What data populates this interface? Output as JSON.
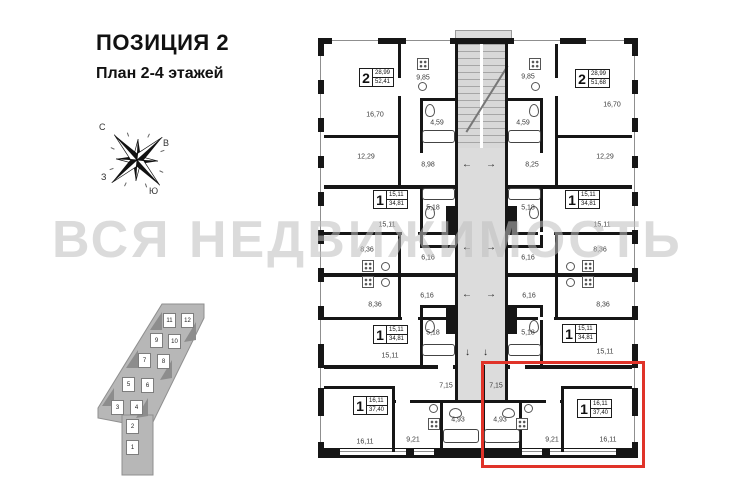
{
  "header": {
    "title": "ПОЗИЦИЯ 2",
    "subtitle": "План 2-4 этажей"
  },
  "watermark": "ВСЯ НЕДВИЖИМОСТЬ",
  "compass": {
    "n": "С",
    "e": "В",
    "s": "Ю",
    "w": "З"
  },
  "site_plan": {
    "blocks": [
      "1",
      "2",
      "3",
      "4",
      "5",
      "6",
      "7",
      "8",
      "9",
      "10",
      "11",
      "12"
    ]
  },
  "floor_plan": {
    "apartments": [
      {
        "rooms": "2",
        "area_living": "28,99",
        "area_total": "52,41"
      },
      {
        "rooms": "2",
        "area_living": "28,99",
        "area_total": "51,68"
      },
      {
        "rooms": "1",
        "area_living": "15,11",
        "area_total": "34,81"
      },
      {
        "rooms": "1",
        "area_living": "15,11",
        "area_total": "34,81"
      },
      {
        "rooms": "1",
        "area_living": "15,11",
        "area_total": "34,81"
      },
      {
        "rooms": "1",
        "area_living": "15,11",
        "area_total": "34,81"
      },
      {
        "rooms": "1",
        "area_living": "16,11",
        "area_total": "37,40"
      },
      {
        "rooms": "1",
        "area_living": "16,11",
        "area_total": "37,40"
      }
    ],
    "room_labels": [
      "16,70",
      "9,85",
      "4,59",
      "8,98",
      "12,29",
      "9,85",
      "16,70",
      "4,59",
      "8,25",
      "12,29",
      "15,11",
      "5,18",
      "8,36",
      "6,16",
      "15,11",
      "5,18",
      "8,36",
      "6,16",
      "8,36",
      "6,16",
      "5,18",
      "15,11",
      "8,36",
      "6,16",
      "5,18",
      "15,11",
      "7,15",
      "4,93",
      "9,21",
      "16,11",
      "7,15",
      "4,93",
      "9,21",
      "16,11"
    ],
    "arrows": {
      "left": "←",
      "right": "→",
      "down": "↓"
    }
  },
  "colors": {
    "highlight": "#e03329",
    "wall": "#161616",
    "core": "#dcdcdc",
    "watermark": "#bfbfbf"
  }
}
